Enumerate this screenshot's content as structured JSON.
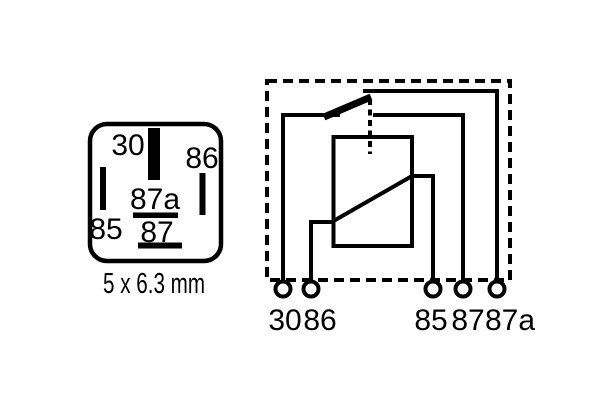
{
  "colors": {
    "ink": "#000000",
    "background": "#ffffff"
  },
  "pinout": {
    "pins": [
      {
        "id": "30",
        "label": "30"
      },
      {
        "id": "86",
        "label": "86"
      },
      {
        "id": "85",
        "label": "85"
      },
      {
        "id": "87a",
        "label": "87a"
      },
      {
        "id": "87",
        "label": "87"
      }
    ],
    "terminal_size_label": "5 x 6.3 mm"
  },
  "schematic": {
    "terminals": [
      {
        "id": "30",
        "label": "30"
      },
      {
        "id": "86",
        "label": "86"
      },
      {
        "id": "85",
        "label": "85"
      },
      {
        "id": "87",
        "label": "87"
      },
      {
        "id": "87a",
        "label": "87a"
      }
    ]
  }
}
